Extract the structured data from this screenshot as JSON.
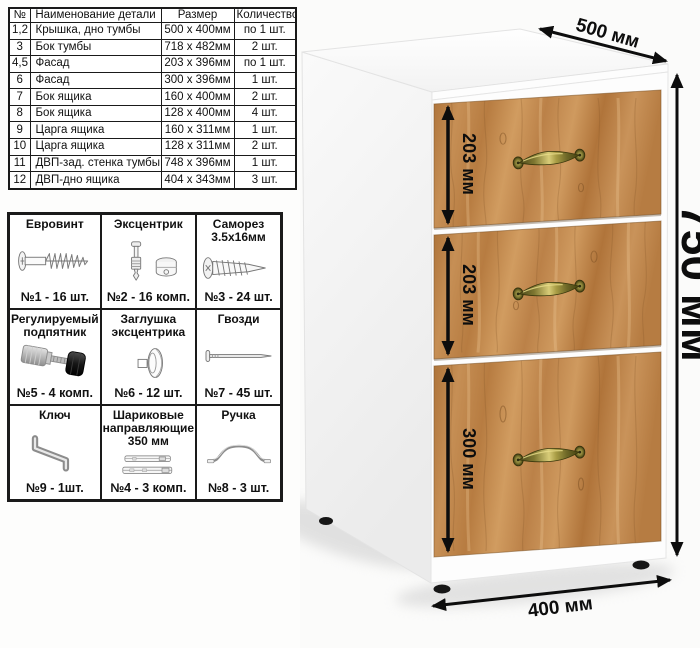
{
  "parts_table": {
    "headers": [
      "№",
      "Наименование детали",
      "Размер",
      "Количество"
    ],
    "rows": [
      {
        "num": "1,2",
        "name": "Крышка, дно тумбы",
        "size": "500 х 400мм",
        "qty": "по 1 шт."
      },
      {
        "num": "3",
        "name": "Бок тумбы",
        "size": "718 х 482мм",
        "qty": "2 шт."
      },
      {
        "num": "4,5",
        "name": "Фасад",
        "size": "203 х 396мм",
        "qty": "по 1 шт."
      },
      {
        "num": "6",
        "name": "Фасад",
        "size": "300 х 396мм",
        "qty": "1 шт."
      },
      {
        "num": "7",
        "name": "Бок ящика",
        "size": "160 х 400мм",
        "qty": "2 шт."
      },
      {
        "num": "8",
        "name": "Бок ящика",
        "size": "128 х 400мм",
        "qty": "4 шт."
      },
      {
        "num": "9",
        "name": "Царга ящика",
        "size": "160 х 311мм",
        "qty": "1 шт."
      },
      {
        "num": "10",
        "name": "Царга ящика",
        "size": "128 х 311мм",
        "qty": "2 шт."
      },
      {
        "num": "11",
        "name": "ДВП-зад. стенка тумбы",
        "size": "748 х 396мм",
        "qty": "1 шт."
      },
      {
        "num": "12",
        "name": "ДВП-дно ящика",
        "size": "404 х 343мм",
        "qty": "3 шт."
      }
    ]
  },
  "hardware": {
    "cells": [
      {
        "title": "Евровинт",
        "count": "№1 - 16 шт.",
        "icon": "euro-screw-icon"
      },
      {
        "title": "Эксцентрик",
        "count": "№2 - 16 комп.",
        "icon": "cam-lock-icon"
      },
      {
        "title": "Саморез\n3.5х16мм",
        "count": "№3 - 24 шт.",
        "icon": "self-tapping-screw-icon"
      },
      {
        "title": "Регулируемый\nподпятник",
        "count": "№5 - 4 комп.",
        "icon": "adjustable-foot-icon"
      },
      {
        "title": "Заглушка\nэксцентрика",
        "count": "№6 - 12 шт.",
        "icon": "cam-cap-icon"
      },
      {
        "title": "Гвозди",
        "count": "№7 - 45 шт.",
        "icon": "nail-icon"
      },
      {
        "title": "Ключ",
        "count": "№9 - 1шт.",
        "icon": "hex-key-icon"
      },
      {
        "title": "Шариковые\nнаправляющие\n350 мм",
        "count": "№4 - 3 комп.",
        "icon": "drawer-slides-icon"
      },
      {
        "title": "Ручка",
        "count": "№8 - 3 шт.",
        "icon": "drawer-handle-icon"
      }
    ]
  },
  "dimensions": {
    "top_width": "500 мм",
    "height": "750 мм",
    "bottom_depth": "400 мм",
    "drawer1_height": "203 мм",
    "drawer2_height": "203 мм",
    "drawer3_height": "300 мм"
  },
  "colors": {
    "wood_base": "#c08a4e",
    "handle_brass": "#8f873a",
    "dimension_ink": "#0d0d0d",
    "cabinet_body": "#ffffff"
  }
}
